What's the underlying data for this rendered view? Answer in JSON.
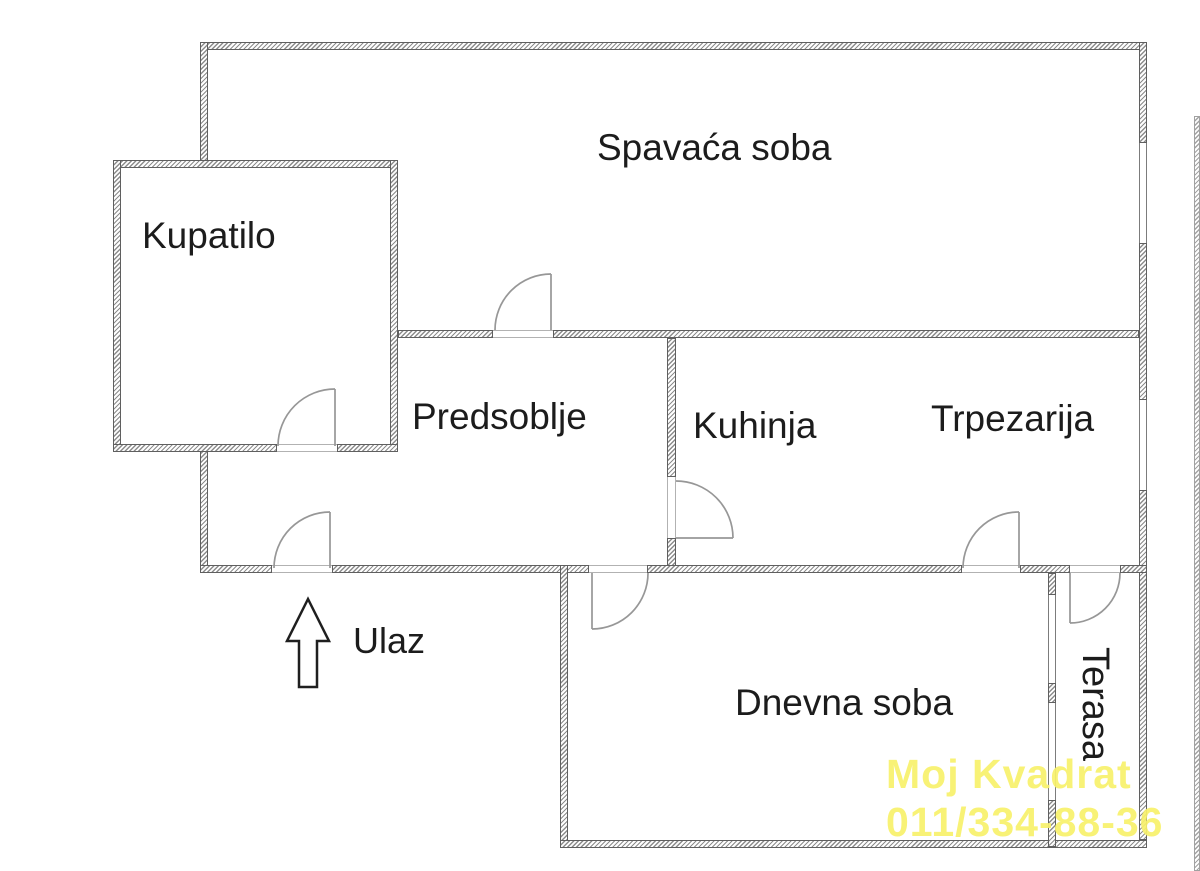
{
  "plan": {
    "rooms": {
      "bedroom": {
        "label": "Spavaća soba"
      },
      "bathroom": {
        "label": "Kupatilo"
      },
      "hallway": {
        "label": "Predsoblje"
      },
      "kitchen": {
        "label": "Kuhinja"
      },
      "dining": {
        "label": "Trpezarija"
      },
      "living": {
        "label": "Dnevna soba"
      },
      "terrace": {
        "label": "Terasa"
      }
    },
    "entrance": {
      "label": "Ulaz"
    }
  },
  "watermark": {
    "line1": "Moj Kvadrat",
    "line2": "011/334-88-36",
    "color": "#f8f16b"
  },
  "colors": {
    "wall_line": "#5f5f5f",
    "door_stroke": "#979797",
    "text": "#1c1c1c"
  }
}
